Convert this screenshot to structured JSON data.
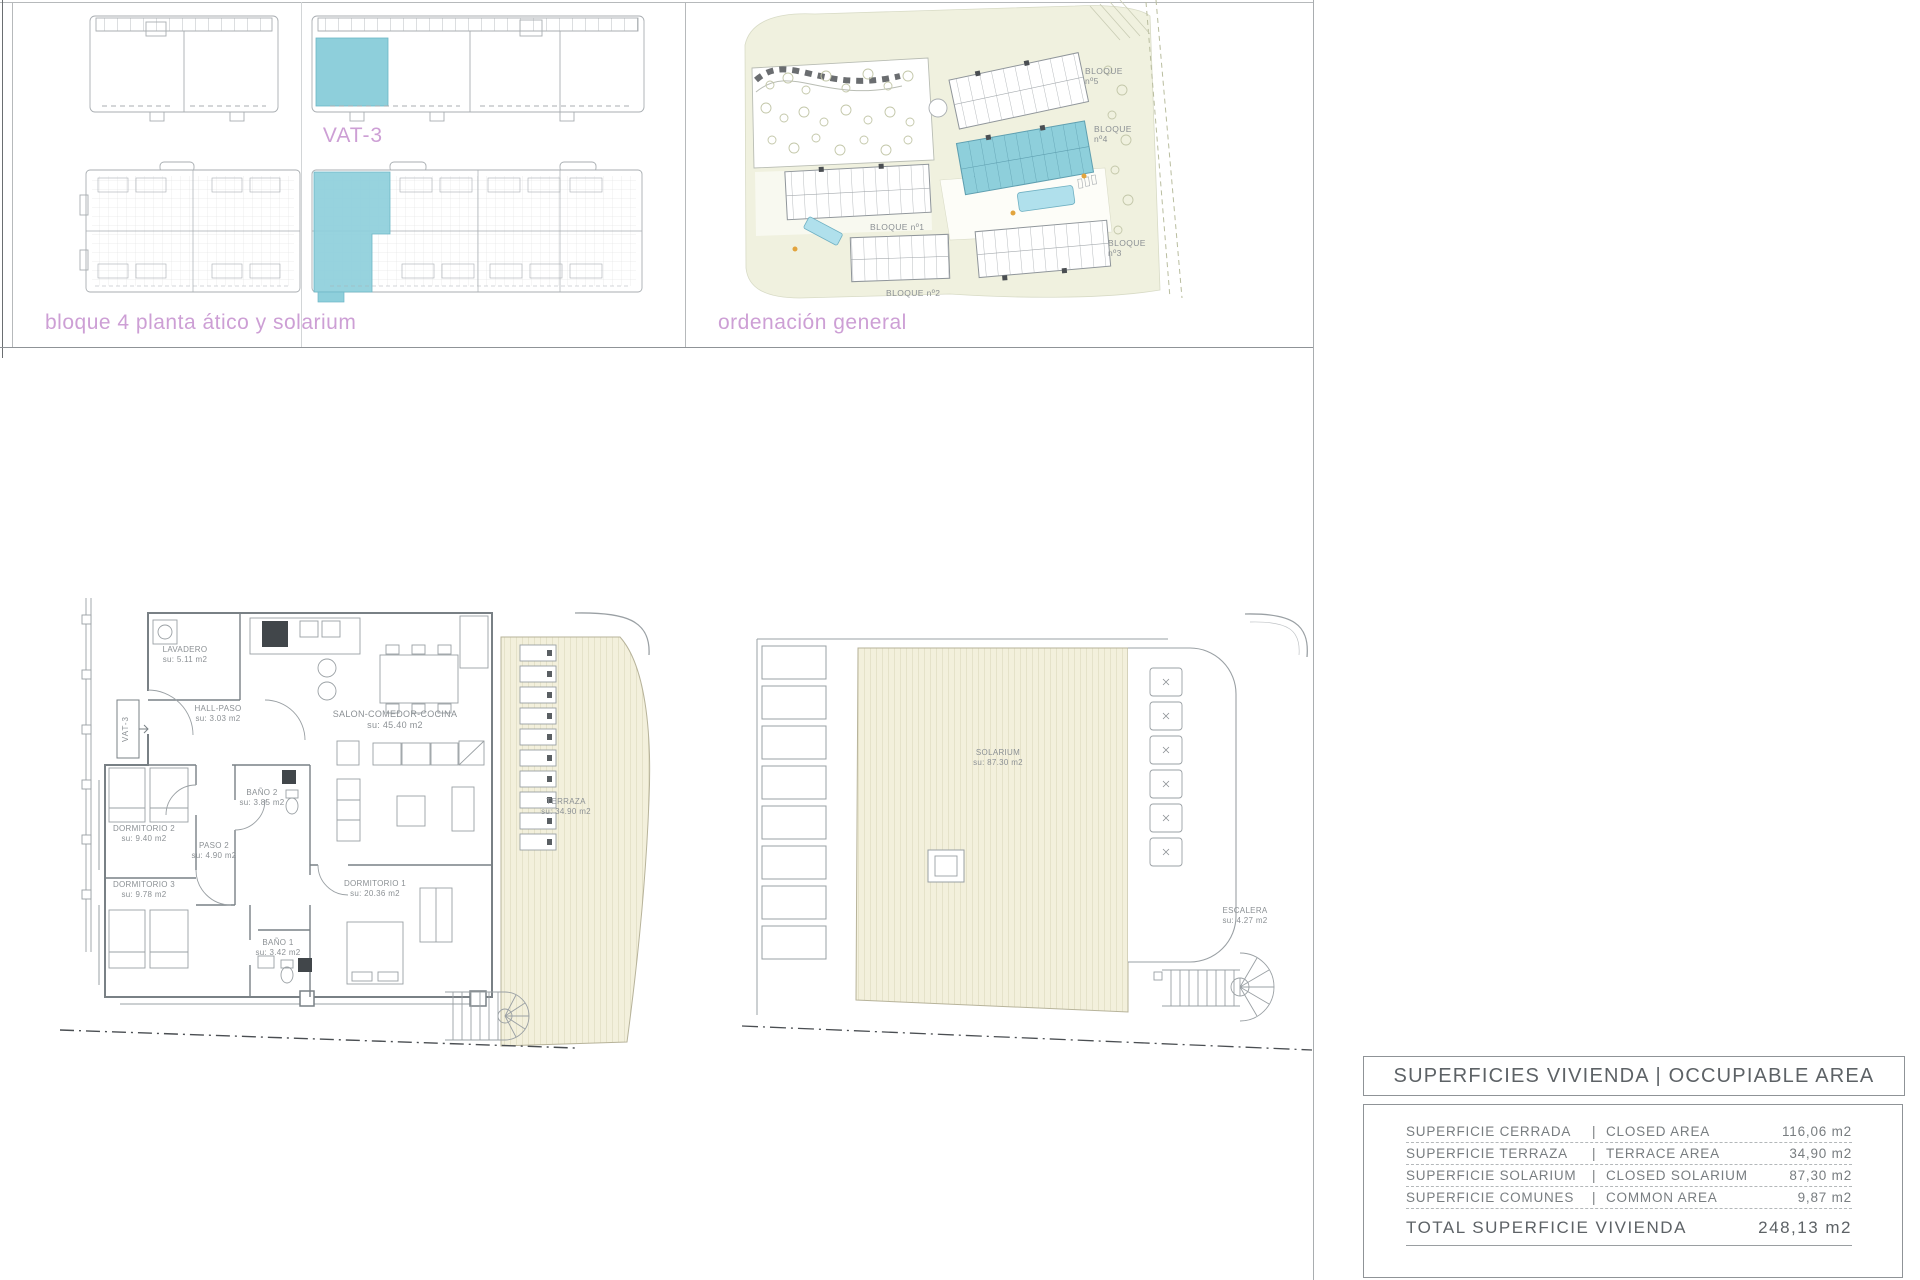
{
  "sheet": {
    "captions": {
      "bloque4": "bloque 4 planta ático y solarium",
      "ordenacion": "ordenación general"
    },
    "unit_tag": "VAT-3",
    "site": {
      "b5_1": "BLOQUE",
      "b5_2": "nº5",
      "b4_1": "BLOQUE",
      "b4_2": "nº4",
      "b1": "BLOQUE nº1",
      "b2": "BLOQUE nº2",
      "b3_1": "BLOQUE",
      "b3_2": "nº3"
    },
    "rooms": {
      "lavadero": {
        "name": "LAVADERO",
        "area": "su: 5.11 m2"
      },
      "hall": {
        "name": "HALL-PASO",
        "area": "su: 3.03 m2"
      },
      "salon": {
        "name": "SALON-COMEDOR-COCINA",
        "area": "su: 45.40 m2"
      },
      "terraza": {
        "name": "TERRAZA",
        "area": "su: 34.90 m2"
      },
      "dorm2": {
        "name": "DORMITORIO 2",
        "area": "su: 9.40 m2"
      },
      "bano2": {
        "name": "BAÑO 2",
        "area": "su: 3.85 m2"
      },
      "paso2": {
        "name": "PASO 2",
        "area": "su: 4.90 m2"
      },
      "dorm3": {
        "name": "DORMITORIO 3",
        "area": "su: 9.78 m2"
      },
      "dorm1": {
        "name": "DORMITORIO 1",
        "area": "su: 20.36 m2"
      },
      "bano1": {
        "name": "BAÑO 1",
        "area": "su: 3.42 m2"
      },
      "solarium": {
        "name": "SOLARIUM",
        "area": "su: 87.30 m2"
      },
      "escalera": {
        "name": "ESCALERA",
        "area": "su: 4.27 m2"
      }
    },
    "area_table": {
      "title": "SUPERFICIES VIVIENDA | OCCUPIABLE AREA",
      "rows": [
        {
          "es": "SUPERFICIE CERRADA",
          "en": "CLOSED AREA",
          "value": "116,06 m2"
        },
        {
          "es": "SUPERFICIE TERRAZA",
          "en": "TERRACE AREA",
          "value": "34,90 m2"
        },
        {
          "es": "SUPERFICIE SOLARIUM",
          "en": "CLOSED SOLARIUM",
          "value": "87,30 m2"
        },
        {
          "es": "SUPERFICIE COMUNES",
          "en": "COMMON AREA",
          "value": "9,87 m2"
        }
      ],
      "total_label": "TOTAL SUPERFICIE VIVIENDA",
      "total_value": "248,13 m2"
    }
  },
  "colors": {
    "highlight_teal": "#8ecfdb",
    "caption_pink": "#cd9fd5",
    "plan_line_gray": "#9aa0a4",
    "deck_beige": "#f3f0dc"
  }
}
